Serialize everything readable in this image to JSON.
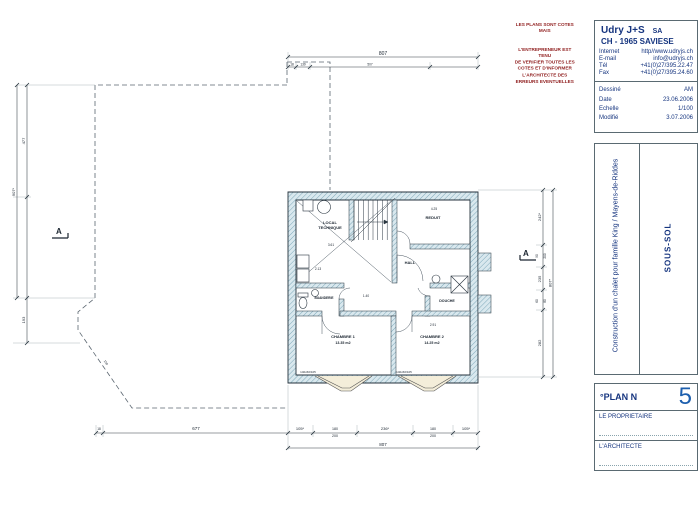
{
  "notes": {
    "line1": "LES PLANS SONT COTES MAIS",
    "l1": "L'ENTREPRENEUR EST TENU",
    "l2": "DE VERIFIER TOUTES LES",
    "l3": "COTES ET D'INFORMER",
    "l4": "L'ARCHITECTE DES",
    "l5": "ERREURS EVENTUELLES"
  },
  "firm": {
    "name": "Udry J+S",
    "legal": "SA",
    "address": "CH - 1965 SAVIESE",
    "internet_label": "Internet",
    "internet": "http//www.udryjs.ch",
    "email_label": "E-mail",
    "email": "info@udryjs.ch",
    "tel_label": "Tél",
    "tel": "+41(0)27/395.22.47",
    "fax_label": "Fax",
    "fax": "+41(0)27/395.24.60",
    "drawn_label": "Dessiné",
    "drawn": "AM",
    "date_label": "Date",
    "date": "23.06.2006",
    "scale_label": "Echelle",
    "scale": "1/100",
    "modified_label": "Modifié",
    "modified": "3.07.2006"
  },
  "project": {
    "title": "Construction d'un chalet pour famille King / Mayens-de-Riddes",
    "sheet": "SOUS-SOL",
    "plan_label": "°PLAN N",
    "plan_number": "5",
    "owner_label": "LE PROPRIETAIRE",
    "architect_label": "L'ARCHITECTE"
  },
  "rooms": {
    "local_1": "LOCAL",
    "local_2": "TECHNIQUE",
    "reduit": "REDUIT",
    "hall": "HALL",
    "buanderie": "BUANDERIE",
    "douche": "DOUCHE",
    "chambre1": "CHAMBRE 1",
    "chambre1_area": "13.35 m2",
    "chambre2": "CHAMBRE 2",
    "chambre2_area": "14.25 m2"
  },
  "dims": {
    "top_total": "807",
    "top_s1": "18",
    "top_s2": "139",
    "top_s3": "507",
    "bot_s0": "18",
    "bot_left": "677",
    "bot_1": "105*",
    "bot_2a": "180",
    "bot_2b": "200",
    "bot_3": "236*",
    "bot_4a": "180",
    "bot_4b": "200",
    "bot_5": "105*",
    "bot_total": "807",
    "left_total": "907*",
    "left_1": "477",
    "left_2": "193",
    "slope": "150",
    "right_total": "807*",
    "right_1": "242*",
    "right_2a": "90",
    "right_2b": "200",
    "right_3": "235",
    "right_4a": "60",
    "right_4b": "80",
    "right_5": "282",
    "int_1": "3.61",
    "int_2": "2.13",
    "int_3": "4.25",
    "int_4": "2.91",
    "int_5": "1.40",
    "win_spec1": "140x60/105",
    "win_spec2": "140x60/105"
  },
  "markers": {
    "section_a": "A"
  },
  "colors": {
    "navy": "#16357f",
    "plan_number_blue": "#1d5fae",
    "note_red": "#8f1d1d",
    "wall_teal": "#7fa9ba"
  }
}
